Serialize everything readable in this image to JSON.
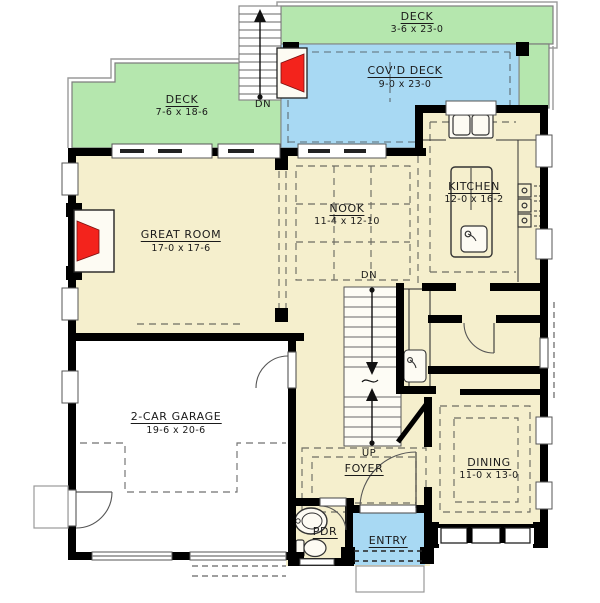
{
  "plan_title": "First floor plan",
  "rooms": {
    "deck_top": {
      "name": "DECK",
      "dims": "3-6 x 23-0"
    },
    "covd_deck": {
      "name": "COV'D DECK",
      "dims": "9-0 x 23-0"
    },
    "deck_left": {
      "name": "DECK",
      "dims": "7-6 x 18-6"
    },
    "great_room": {
      "name": "GREAT ROOM",
      "dims": "17-0 x 17-6"
    },
    "nook": {
      "name": "NOOK",
      "dims": "11-4 x 12-10"
    },
    "kitchen": {
      "name": "KITCHEN",
      "dims": "12-0 x 16-2"
    },
    "garage": {
      "name": "2-CAR GARAGE",
      "dims": "19-6 x 20-6"
    },
    "dining": {
      "name": "DINING",
      "dims": "11-0 x 13-0"
    },
    "foyer": {
      "name": "FOYER"
    },
    "pdr": {
      "name": "PDR"
    },
    "entry": {
      "name": "ENTRY"
    }
  },
  "annotations": {
    "deck_stairs_down": "DN",
    "basement_stairs_down": "DN",
    "stairs_up": "UP"
  },
  "colors": {
    "floor": "#f5efcd",
    "deck_green": "#b5e7ae",
    "covered_deck_blue": "#a8d9f3",
    "entry_blue": "#a8d9f3",
    "fireplace_red": "#f3231c",
    "wall_black": "#000000",
    "garage_floor": "#ffffff",
    "thin_outline_gray": "#8a8a8a"
  }
}
